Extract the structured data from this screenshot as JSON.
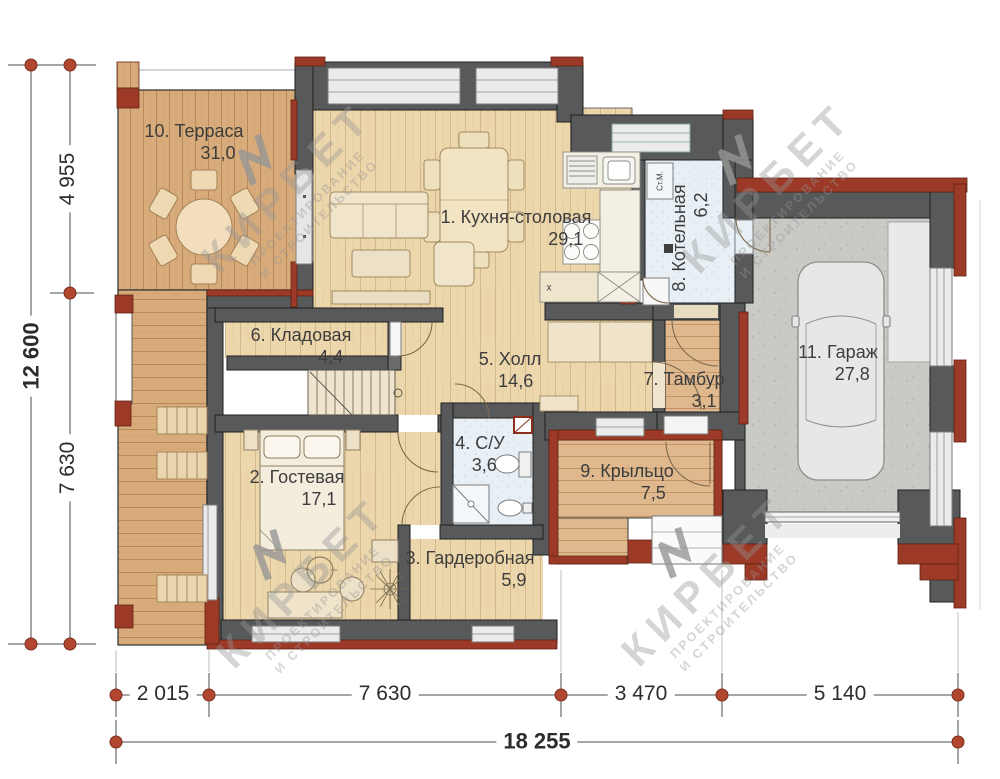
{
  "watermark": {
    "brand": "КИРБЕТ",
    "line1": "ПРОЕКТИРОВАНИЕ",
    "line2": "И СТРОИТЕЛЬСТВО"
  },
  "rooms": {
    "kitchen": {
      "name": "1. Кухня-столовая",
      "area": "29,1"
    },
    "guest": {
      "name": "2. Гостевая",
      "area": "17,1"
    },
    "wardrobe": {
      "name": "3. Гардеробная",
      "area": "5,9"
    },
    "bathroom": {
      "name": "4. С/У",
      "area": "3,6"
    },
    "hall": {
      "name": "5. Холл",
      "area": "14,6"
    },
    "storage": {
      "name": "6. Кладовая",
      "area": "4,4"
    },
    "vestibule": {
      "name": "7. Тамбур",
      "area": "3,1"
    },
    "boiler": {
      "name": "8. Котельная",
      "area": "6,2"
    },
    "porch": {
      "name": "9. Крыльцо",
      "area": "7,5"
    },
    "terrace": {
      "name": "10. Терраса",
      "area": "31,0"
    },
    "garage": {
      "name": "11. Гараж",
      "area": "27,8"
    }
  },
  "annotations": {
    "washing_machine": "Ст.М.",
    "island_mark": "х"
  },
  "dimensions": {
    "left": {
      "total": "12 600",
      "segments": {
        "top": "4 955",
        "bottom": "7 630"
      }
    },
    "bottom": {
      "total": "18 255",
      "segments": {
        "s1": "2 015",
        "s2": "7 630",
        "s3": "3 470",
        "s4": "5 140"
      }
    }
  },
  "colors": {
    "wall": "#58595b",
    "accent_red": "#9c3a27",
    "dim_dot": "#b0472e",
    "tile": "#e8f0f6",
    "interior_wood": "#ecd6ab",
    "terrace_wood": "#d8ab7a",
    "concrete": "#c9c9c6",
    "text": "#3d3d3d"
  }
}
